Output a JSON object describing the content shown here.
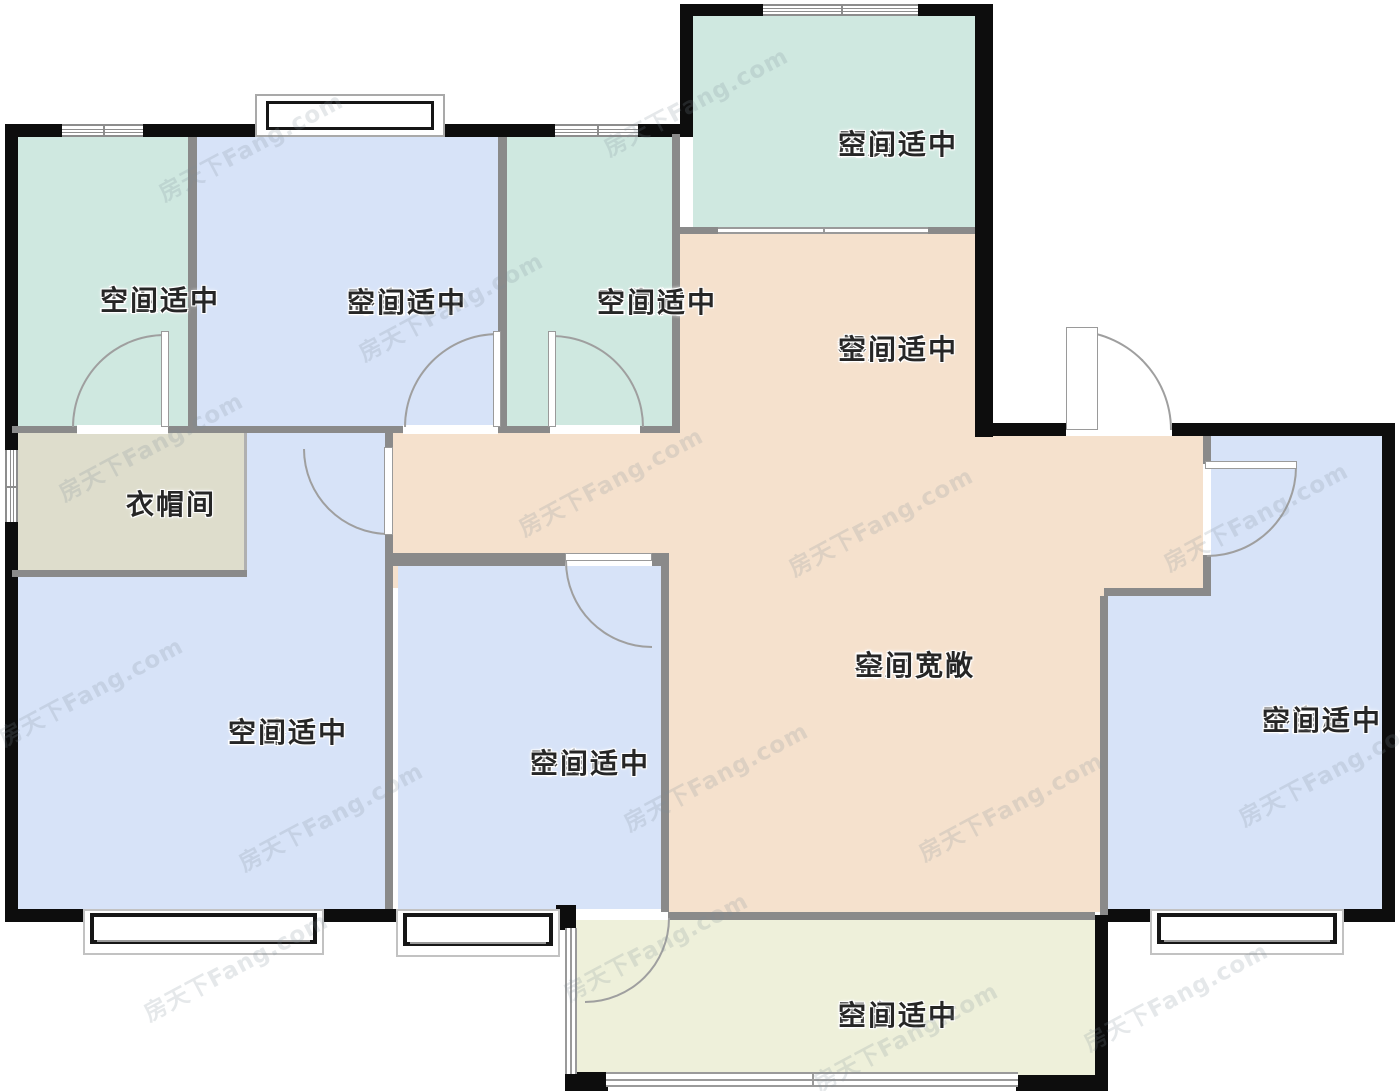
{
  "rooms": {
    "master_bath": {
      "name": "主卫",
      "note": "空间适中"
    },
    "bedroom_c": {
      "name": "卧室C",
      "note": "空间适中"
    },
    "bathroom": {
      "name": "卫生间",
      "note": "空间适中"
    },
    "kitchen": {
      "name": "厨房",
      "note": "空间适中"
    },
    "dining": {
      "name": "餐厅",
      "note": "空间适中"
    },
    "cloakroom": {
      "name": "衣帽间"
    },
    "master_bedroom": {
      "name": "主卧",
      "note": "空间适中"
    },
    "bedroom_b": {
      "name": "卧室B",
      "note": "空间适中"
    },
    "living": {
      "name": "客厅",
      "note": "空间宽敞"
    },
    "bedroom_a": {
      "name": "卧室A",
      "note": "空间适中"
    },
    "balcony": {
      "name": "阳台",
      "note": "空间适中"
    }
  },
  "watermark": {
    "text": "房天下Fang.com"
  },
  "colors": {
    "teal": "#cfe8e0",
    "blue": "#d7e3f8",
    "peach": "#f5e1cd",
    "beige": "#deddcc",
    "balcony": "#eef0da",
    "wall": "#0d0d0d",
    "partition": "#8a8a8a"
  }
}
